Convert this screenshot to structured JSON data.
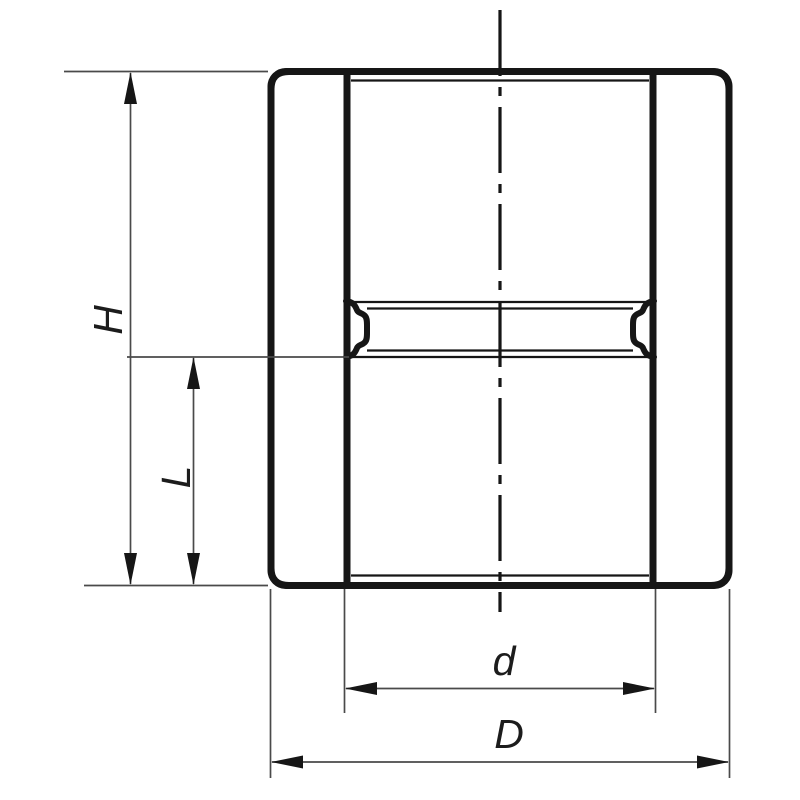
{
  "page": {
    "background": "#ffffff",
    "kind": "technical-drawing"
  },
  "drawing": {
    "subject": "pipe-coupling-socket-fitting-front-section",
    "colors": {
      "part_line": "#161616",
      "dimension_line": "#4a4a4a",
      "label_text": "#1c1c1c"
    },
    "labels": {
      "overall_height": "H",
      "socket_depth": "L",
      "inner_diameter": "d",
      "outer_diameter": "D"
    }
  }
}
